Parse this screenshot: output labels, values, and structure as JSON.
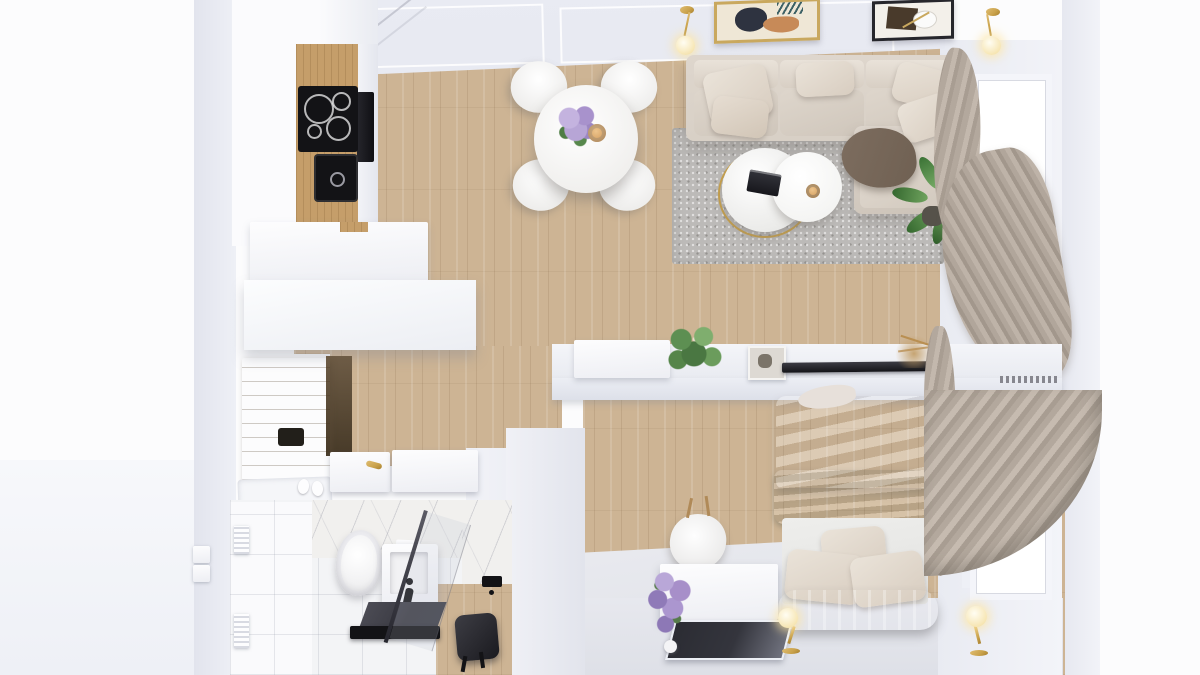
{
  "scene": {
    "title": "Studio apartment — top-down 3D interior render",
    "view": "top-down floor plan",
    "style": "photorealistic render, no visible text or UI"
  },
  "palette": {
    "exterior": "#fcfcfd",
    "wall_light": "#eef0f6",
    "wall_mid": "#e2e4ed",
    "ceiling": "#e7e9f1",
    "wood_floor": "#cdb494",
    "wood_kitchen": "#c59e6a",
    "wood_door": "#b9905c",
    "appliance_black": "#131316",
    "sofa_beige": "#d8d0c6",
    "pillow_cream": "#eae3d9",
    "throw_brown": "#6f6052",
    "rug_gray": "#bcbab8",
    "marble_white": "#f1f0ee",
    "curtain_taupe": "#b3a89d",
    "bed_duvet": "#d8cfc7",
    "throw_sage": "#9ba08f",
    "bench_gray": "#9e9fa3",
    "brass_gold": "#c9a24b",
    "plant_green": "#55854a",
    "lilac_purple": "#a78fc9",
    "floor_light": "#e7e8ee",
    "glass_dark": "#3a3a42",
    "mirror_dark": "#34353d",
    "tile_white": "#f3f4f6"
  },
  "rooms": {
    "kitchen": {
      "label": "Kitchen",
      "objects": [
        "white cabinets",
        "oak worktop",
        "black induction cooktop",
        "black sink",
        "wall oven",
        "two-tier island counter"
      ]
    },
    "dining": {
      "label": "Dining area",
      "objects": [
        "round white table",
        "4 white shell chairs",
        "hydrangea bouquet",
        "amber candle cup"
      ]
    },
    "living": {
      "label": "Living room",
      "objects": [
        "beige sectional sofa with chaise",
        "cushions",
        "brown throw",
        "nesting marble coffee tables with brass ring",
        "book",
        "gray rug",
        "monstera plant",
        "2 framed artworks",
        "2 brass sconces"
      ]
    },
    "hallway": {
      "label": "Hallway",
      "objects": [
        "oak entry door with black pull",
        "white open double door with brass handle",
        "doormat",
        "slippers"
      ]
    },
    "bathroom": {
      "label": "Bathroom",
      "objects": [
        "toilet",
        "vanity washbasin",
        "black faucet",
        "glass shower screen",
        "dark shower tray",
        "black stool",
        "marble wall",
        "white tile wall",
        "wall vents"
      ]
    },
    "bedroom": {
      "label": "Bedroom",
      "objects": [
        "double bed",
        "beige duvet",
        "sage velvet throw",
        "3 pillows",
        "channel-tufted bench",
        "2 brass globe lamps",
        "white dresser",
        "leaning mirror",
        "lilac bouquet",
        "white desk chair",
        "TV half-wall console",
        "flat TV",
        "fittonia plant",
        "picture frame",
        "dried grass",
        "window",
        "floor-length curtains"
      ]
    }
  },
  "objects": {
    "sofa": "Beige sectional sofa",
    "chaise": "Chaise lounge with brown throw",
    "rug": "Gray speckled rug",
    "coffee_tables": "Nesting round coffee tables",
    "dining_table": "Round dining table",
    "dining_chair": "White dining chair",
    "cooktop": "Induction cooktop",
    "sink": "Black kitchen sink",
    "oven": "Built-in wall oven",
    "island": "Kitchen island counter",
    "entry_door": "Oak entry door",
    "interior_door": "White interior door",
    "toilet": "Wall-hung toilet",
    "vanity": "Washbasin vanity",
    "shower": "Walk-in shower",
    "stool": "Black stool",
    "bed": "Double bed",
    "bench": "Tufted bed bench",
    "lamp": "Brass globe lamp",
    "mirror": "Leaning mirror",
    "dresser": "White dresser",
    "tv": "Flat TV on console wall",
    "curtain": "Taupe curtains",
    "window": "White window",
    "monstera": "Monstera plant",
    "fittonia": "Fittonia plant",
    "lilac": "Lilac bouquet",
    "artwork": "Framed abstract artwork",
    "sconce": "Brass wall sconce"
  }
}
